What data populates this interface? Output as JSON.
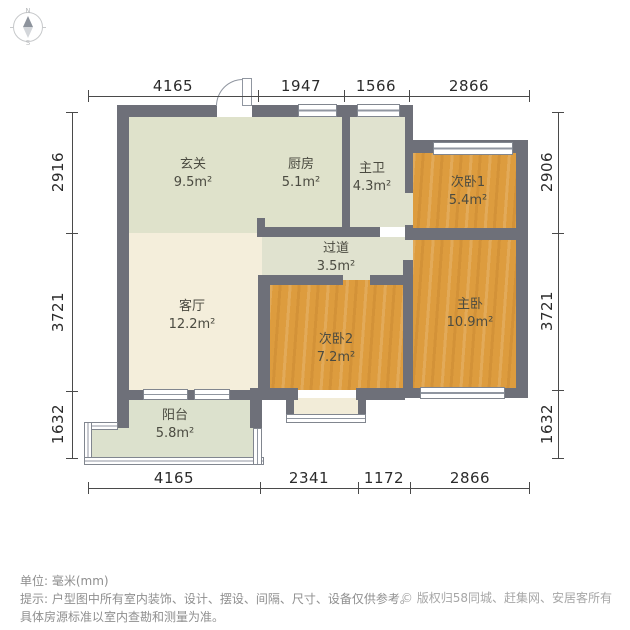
{
  "plan": {
    "rooms": [
      {
        "name": "玄关",
        "area": "9.5m²"
      },
      {
        "name": "厨房",
        "area": "5.1m²"
      },
      {
        "name": "主卫",
        "area": "4.3m²"
      },
      {
        "name": "次卧1",
        "area": "5.4m²"
      },
      {
        "name": "过道",
        "area": "3.5m²"
      },
      {
        "name": "客厅",
        "area": "12.2m²"
      },
      {
        "name": "次卧2",
        "area": "7.2m²"
      },
      {
        "name": "主卧",
        "area": "10.9m²"
      },
      {
        "name": "阳台",
        "area": "5.8m²"
      }
    ],
    "dimensions": {
      "top": [
        "4165",
        "1947",
        "1566",
        "2866"
      ],
      "bottom": [
        "4165",
        "2341",
        "1172",
        "2866"
      ],
      "left": [
        "2916",
        "3721",
        "1632"
      ],
      "right": [
        "2906",
        "3721",
        "1632"
      ]
    }
  },
  "compass": {
    "north": "N",
    "south": "S"
  },
  "footer": {
    "unit_line": "单位: 毫米(mm)",
    "hint_line1": "提示: 户型图中所有室内装饰、设计、摆设、间隔、尺寸、设备仅供参考。",
    "hint_line2": "具体房源标准以室内查勘和测量为准。",
    "copyright_symbol": "©",
    "copyright_text": "版权归58同城、赶集网、安居客所有"
  },
  "colors": {
    "wall": "#6e7079",
    "room_green": "#dfe2cb",
    "room_cream": "#f4eedb",
    "room_wood": "#dd9c3e",
    "balcony_green": "#dce1cd",
    "dim_text": "#2b2b2b",
    "note_text": "#8f8f8f",
    "copyright_text_color": "#a6a6a6"
  }
}
